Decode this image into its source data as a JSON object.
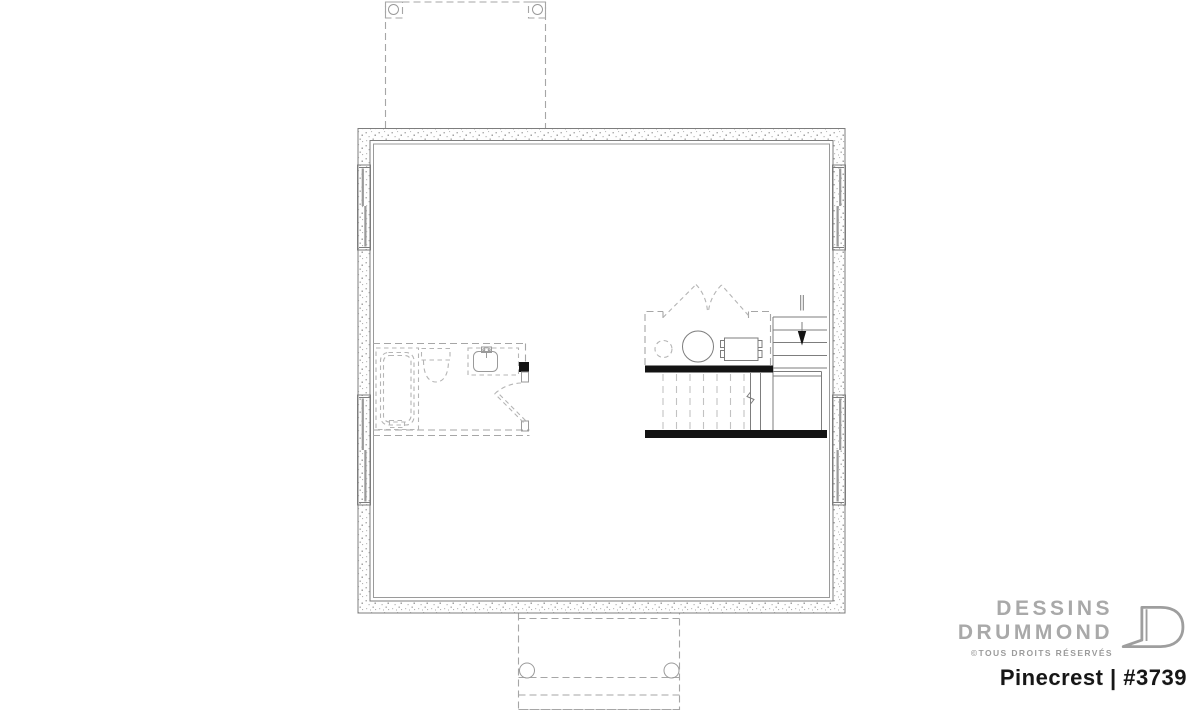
{
  "branding": {
    "studio_line1": "DESSINS",
    "studio_line2": "DRUMMOND",
    "copyright": "©TOUS DROITS RÉSERVÉS",
    "plan_title": "Pinecrest | #3739"
  },
  "colors": {
    "background": "#ffffff",
    "thin_line": "#7d7d7d",
    "dashed_line": "#a6a6a6",
    "solid_wall": "#131313",
    "brand_gray": "#a9a9a9",
    "title_text": "#161616"
  },
  "plan_symbols": {
    "drawing_type": "basement-foundation-floor-plan",
    "fixtures": [
      "bathtub",
      "toilet",
      "sink-vanity",
      "interior-door-swing",
      "bifold-closet-doors",
      "water-heater",
      "furnace",
      "stairs",
      "stairs-down-arrow",
      "porch-posts"
    ],
    "stairs_direction": "down"
  }
}
